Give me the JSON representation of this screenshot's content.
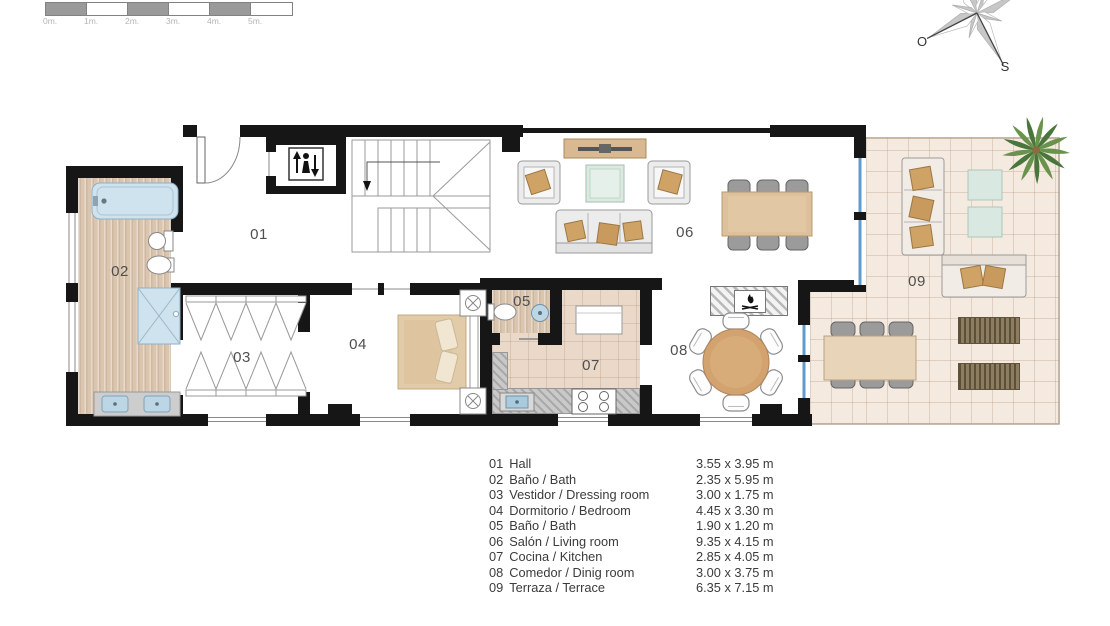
{
  "scale_bar": {
    "tick_labels": [
      "0m.",
      "1m.",
      "2m.",
      "3m.",
      "4m.",
      "5m."
    ],
    "segment_colors": [
      "#9a9a9a",
      "#ffffff",
      "#9a9a9a",
      "#ffffff",
      "#9a9a9a",
      "#ffffff"
    ]
  },
  "compass": {
    "west_label": "O",
    "south_label": "S"
  },
  "legend": {
    "rows": [
      {
        "number": "01",
        "name": "Hall",
        "dimensions": "3.55 x 3.95 m"
      },
      {
        "number": "02",
        "name": "Baño / Bath",
        "dimensions": "2.35 x 5.95 m"
      },
      {
        "number": "03",
        "name": "Vestidor / Dressing room",
        "dimensions": "3.00 x 1.75 m"
      },
      {
        "number": "04",
        "name": "Dormitorio / Bedroom",
        "dimensions": "4.45 x 3.30 m"
      },
      {
        "number": "05",
        "name": "Baño / Bath",
        "dimensions": "1.90 x 1.20 m"
      },
      {
        "number": "06",
        "name": "Salón / Living room",
        "dimensions": "9.35 x 4.15 m"
      },
      {
        "number": "07",
        "name": "Cocina / Kitchen",
        "dimensions": "2.85 x 4.05 m"
      },
      {
        "number": "08",
        "name": "Comedor / Dinig room",
        "dimensions": "3.00 x 3.75 m"
      },
      {
        "number": "09",
        "name": "Terraza / Terrace",
        "dimensions": "6.35 x 7.15 m"
      }
    ]
  },
  "colors": {
    "wall": "#161616",
    "water_blue": "#cfe3ef",
    "wood_floor": "#dac5af",
    "kitchen_tile": "#ead9c9",
    "terrace_tile": "#f5eadf",
    "furniture_tan": "#d2a36f",
    "pillow_tan": "#cfa265",
    "glass_green": "#dbe9e1",
    "glazing_blue": "#5f9ccb",
    "lounger_brown": "#8d7d60"
  }
}
